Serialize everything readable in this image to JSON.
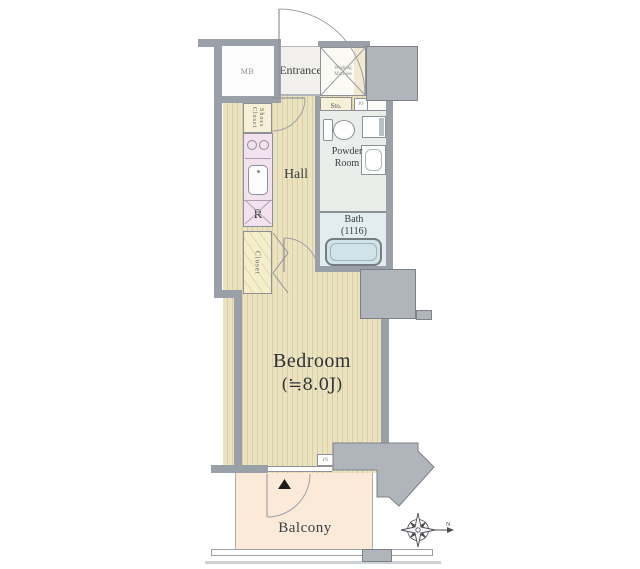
{
  "labels": {
    "mb": "MB",
    "entrance": "Entrance",
    "washing_line1": "Washing",
    "washing_line2": "Machine",
    "storage": "Sto.",
    "ps_top": "PS",
    "shoes_line1": "Shoes",
    "shoes_line2": "Closet",
    "hall": "Hall",
    "powder_line1": "Powder",
    "powder_line2": "Room",
    "bath_line1": "Bath",
    "bath_line2": "(1116)",
    "refrigerator": "R",
    "closet": "Closet",
    "bedroom_line1": "Bedroom",
    "bedroom_line2": "(≒8.0J)",
    "ps_bottom": "PS",
    "balcony": "Balcony",
    "compass_north": "N"
  },
  "colors": {
    "wall": "#9aa0a8",
    "structure_block": "#b0b4bb",
    "flooring_base": "#ebe3bf",
    "flooring_stripe": "#d9cfa6",
    "kitchen": "#f2e1ee",
    "storage_yellow": "#f5f0d6",
    "powder_room": "#e9eeeb",
    "bath": "#e3ecee",
    "bathtub": "#cfe3e9",
    "balcony": "#fcead9",
    "entrance": "#f1f0ec",
    "text": "#33373c"
  }
}
